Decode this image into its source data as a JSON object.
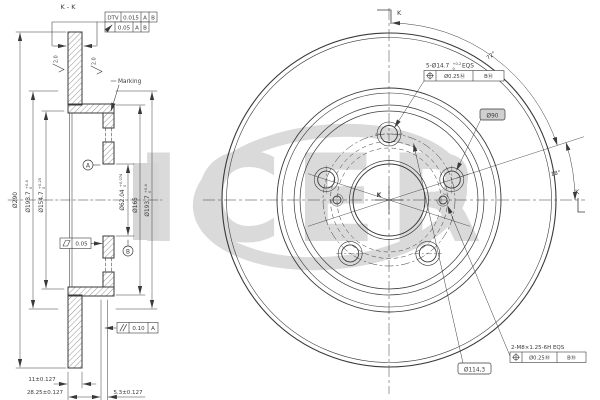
{
  "drawing": {
    "title": "K - K",
    "watermark_text": "ICER",
    "colors": {
      "line": "#3a3a3a",
      "watermark": "#dadada",
      "highlight": "#d6d6d6"
    },
    "top_frames": {
      "dtv": {
        "label": "DTV",
        "value": "0.015",
        "datum_a": "A",
        "datum_b": "B"
      },
      "runout": {
        "value": "0.05",
        "datum_a": "A",
        "datum_b": "B"
      }
    },
    "surface_finish": {
      "left": "2.0",
      "right": "2.0"
    },
    "marking_label": "Marking",
    "datum_a": "A",
    "datum_b": "B",
    "flatness": {
      "value": "0.05"
    },
    "parallelism": {
      "value": "0.10",
      "datum": "A"
    },
    "left_dims": {
      "outer": {
        "value": "Ø290"
      },
      "hat_outer_left": {
        "value": "Ø193.7",
        "tol_up": "+0.4",
        "tol_dn": "0"
      },
      "hat_inner": {
        "value": "Ø154.7",
        "tol_up": "+0.25",
        "tol_dn": "0"
      },
      "bore": {
        "value": "Ø62.04",
        "tol_up": "+0.074",
        "tol_dn": "0"
      },
      "pilot": {
        "value": "Ø165"
      },
      "hat_outer_right": {
        "value": "Ø193.7",
        "tol_up": "+0.4",
        "tol_dn": "0"
      },
      "thickness": "11±0.127",
      "height": "28.25±0.127",
      "flange": "5.3±0.127"
    },
    "right_view": {
      "section_k_top": "K",
      "section_k_right": "K",
      "center_k": "K",
      "angle_bolt_spacing": "72°",
      "angle_bolt_offset": "18°",
      "bolt_holes": {
        "prefix": "5-Ø14.7",
        "tol_up": "+0.2",
        "tol_dn": "0",
        "suffix": "EQS",
        "position": "Ø0.25Ⓜ",
        "datum": "BⓂ"
      },
      "thread_holes": {
        "label": "2-M8×1.25-6H EQS",
        "position": "Ø0.25Ⓜ",
        "datum": "BⓂ"
      },
      "pcd_label": "Ø114,3",
      "thread_pcd_label": "Ø90"
    }
  }
}
